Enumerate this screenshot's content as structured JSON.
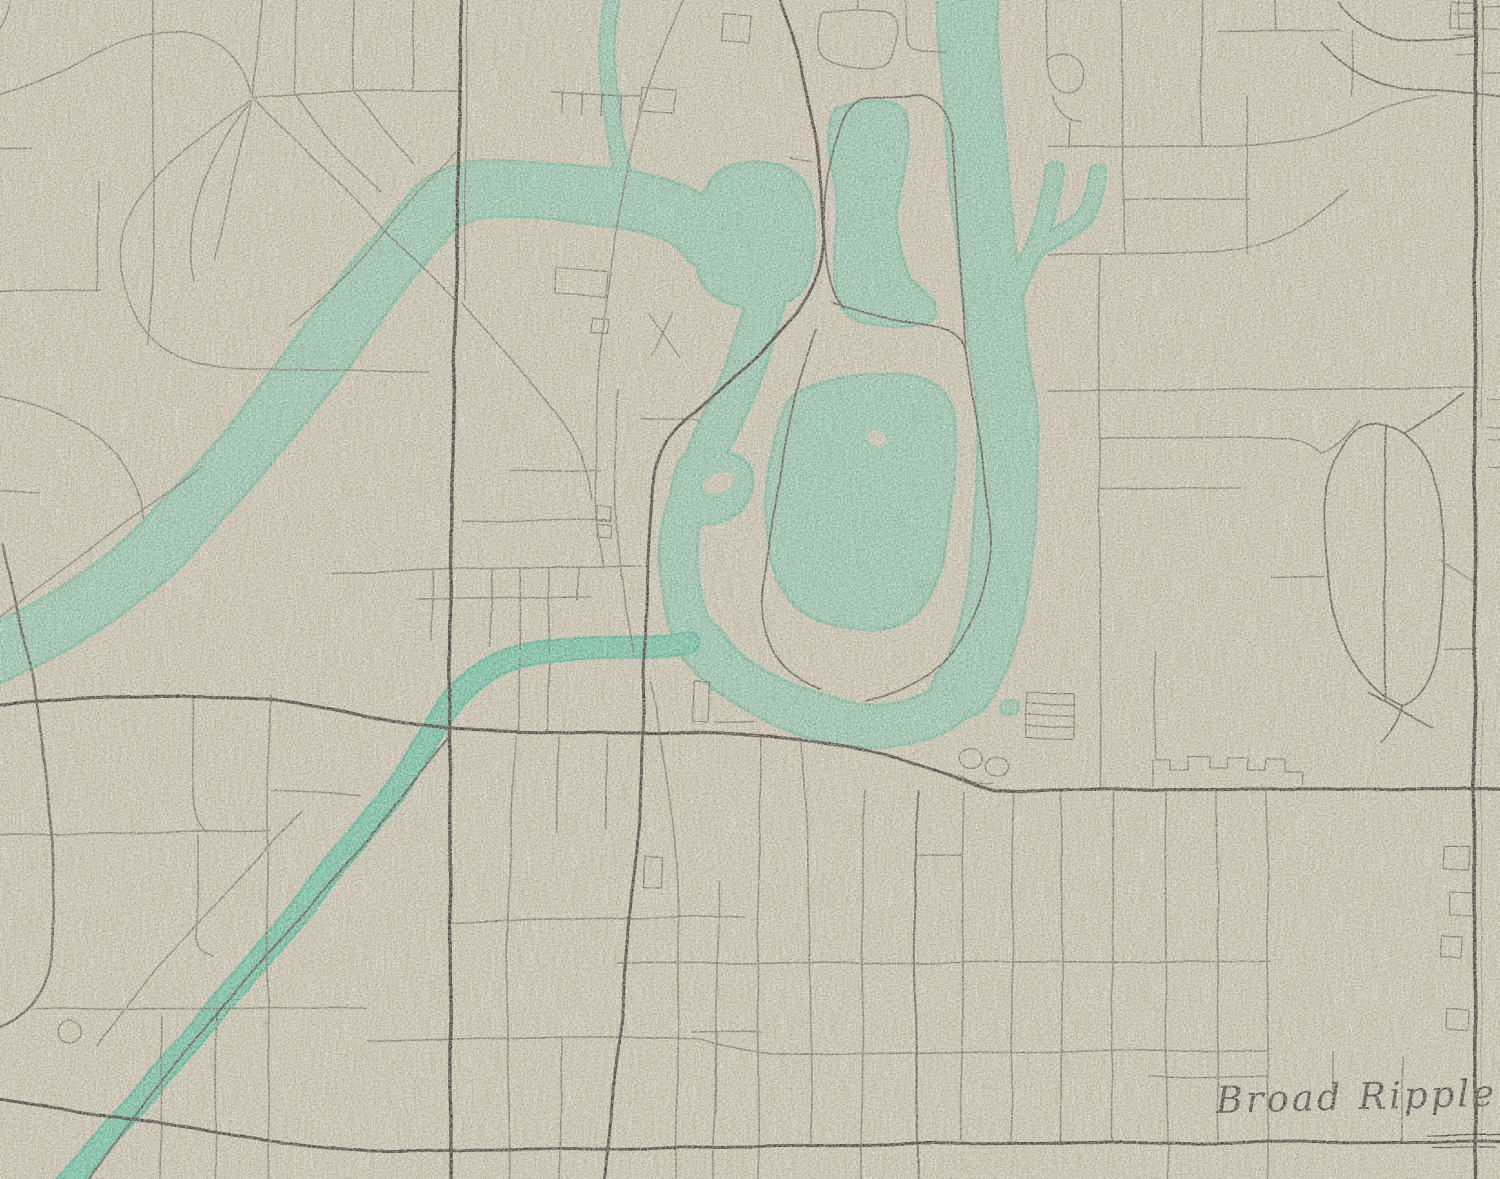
{
  "map": {
    "place_label": "Broad Ripple",
    "colors": {
      "paper": "#d8d2be",
      "paper_dark": "#6e6552",
      "paper_light": "#ffffff",
      "streak": "#8a8168",
      "water": "#92d4ba",
      "water_edge": "#74c4a8",
      "canal": "#5eccab",
      "canal_edge": "#3fbd9a",
      "road_major": "#28231f",
      "road_medium": "#3e3831",
      "road_minor": "#5f584c",
      "rail": "#1e1a17",
      "ink": "#272220"
    }
  }
}
